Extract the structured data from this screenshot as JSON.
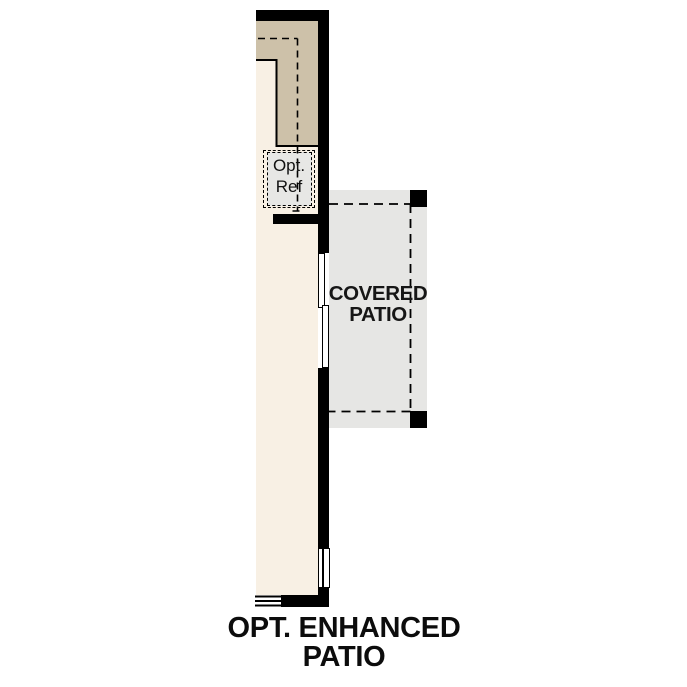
{
  "colors": {
    "wall": "#000000",
    "interior_floor": "#f8f0e4",
    "kitchen_counter": "#cdc1a9",
    "patio_fill": "#e6e6e4",
    "fridge_fill": "#e7e7e5",
    "text": "#111111",
    "background": "#ffffff"
  },
  "floorplan": {
    "kitchen": {
      "opt_ref_label_line1": "Opt.",
      "opt_ref_label_line2": "Ref"
    },
    "covered_patio": {
      "label_line1": "COVERED",
      "label_line2": "PATIO"
    },
    "title": {
      "line1": "OPT. ENHANCED",
      "line2": "PATIO"
    }
  }
}
